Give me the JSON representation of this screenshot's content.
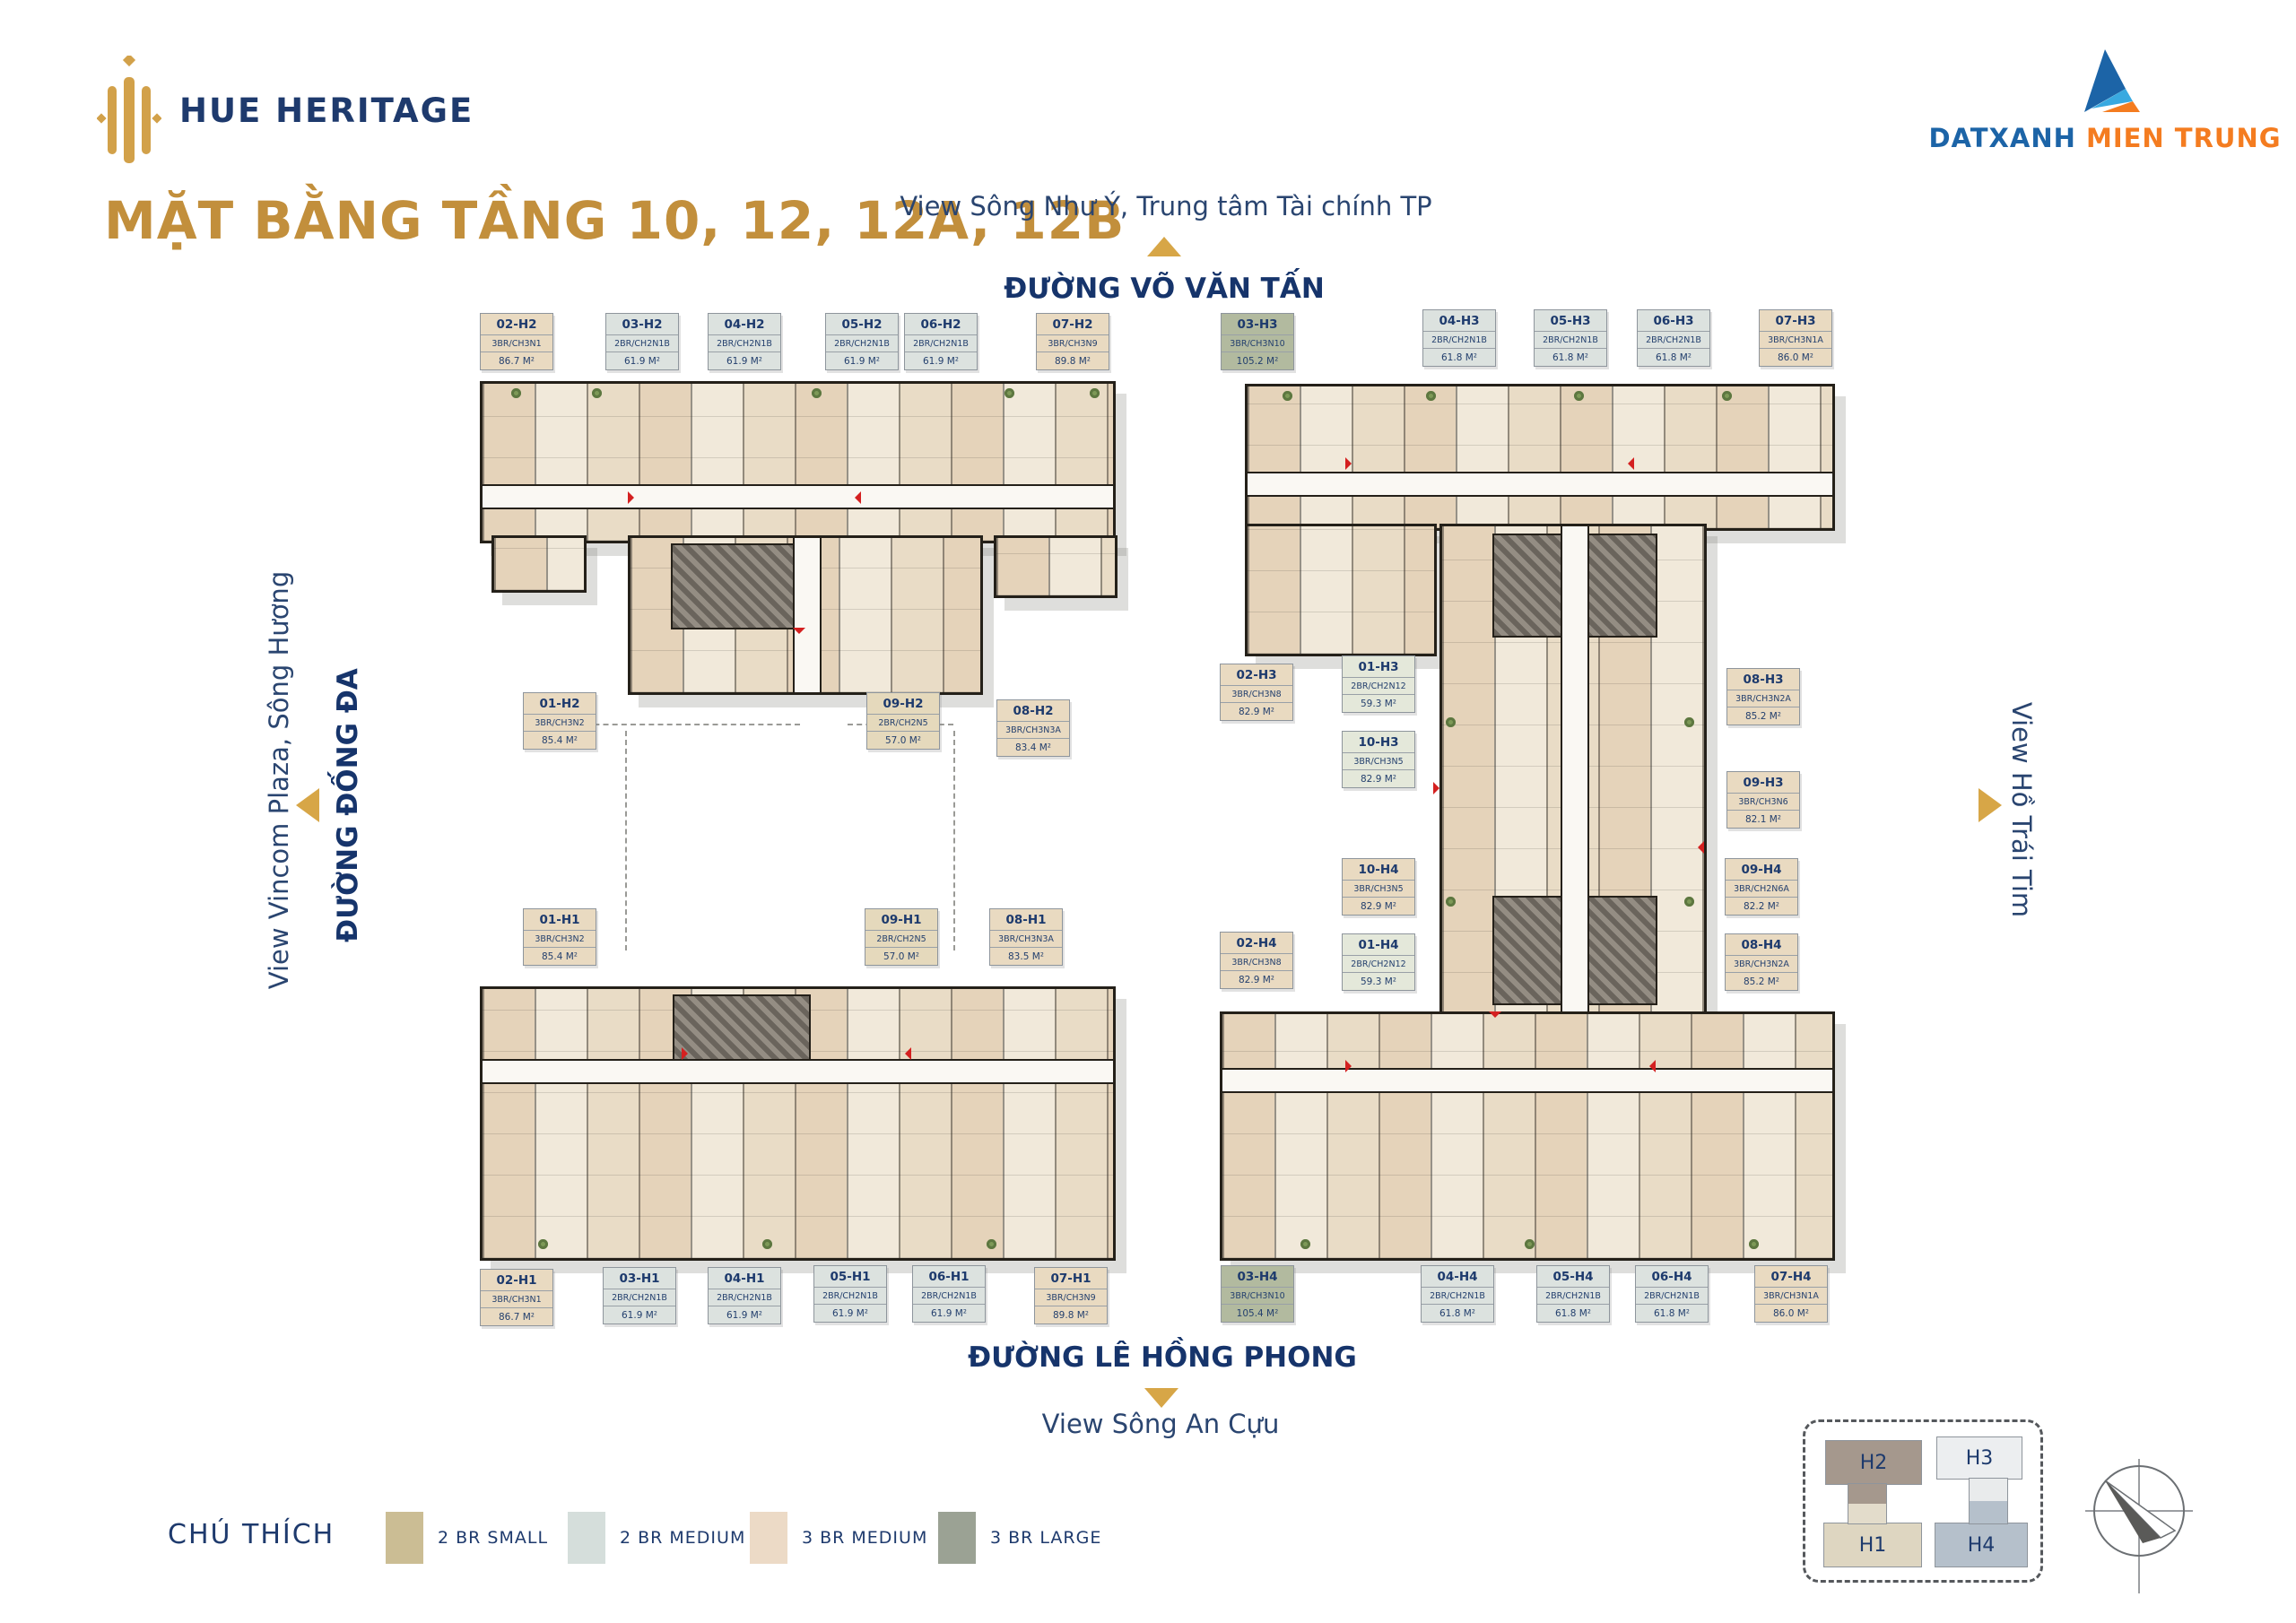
{
  "branding": {
    "logo_text": "HUE HERITAGE",
    "developer": {
      "part1": "DATXANH",
      "part2": "MIEN TRUNG"
    }
  },
  "title": "MẶT BẰNG TẦNG 10, 12, 12A, 12B",
  "directions": {
    "top": {
      "view": "View Sông Như Ý, Trung tâm Tài chính TP",
      "street": "ĐƯỜNG VÕ VĂN TẤN"
    },
    "left": {
      "view": "View Vincom Plaza, Sông Hương",
      "street": "ĐƯỜNG ĐỐNG ĐA"
    },
    "right": {
      "view": "View Hồ Trái Tim"
    },
    "bottom": {
      "street": "ĐƯỜNG LÊ HỒNG PHONG",
      "view": "View Sông An Cựu"
    }
  },
  "legend": {
    "title": "CHÚ THÍCH",
    "items": [
      {
        "label": "2 BR SMALL",
        "color": "#cbbd94"
      },
      {
        "label": "2 BR MEDIUM",
        "color": "#d5dedb"
      },
      {
        "label": "3 BR MEDIUM",
        "color": "#ecdac6"
      },
      {
        "label": "3 BR LARGE",
        "color": "#9ba294"
      }
    ]
  },
  "keyplan": {
    "blocks": [
      {
        "label": "H2",
        "color": "#a5988d"
      },
      {
        "label": "H3",
        "color": "#eceef0"
      },
      {
        "label": "H1",
        "color": "#ded6c1"
      },
      {
        "label": "H4",
        "color": "#b5c0cb"
      }
    ]
  },
  "tones": {
    "br2-small": "#e5d9bc",
    "br2-small-sage": "#e4e8da",
    "br2-medium": "#dce2df",
    "br3-medium": "#e9dac1",
    "br3-large": "#b2ba9f"
  },
  "units": [
    {
      "code": "02-H2",
      "type": "3BR/CH3N1",
      "area": "86.7 M²",
      "tone": "br3-medium"
    },
    {
      "code": "03-H2",
      "type": "2BR/CH2N1B",
      "area": "61.9 M²",
      "tone": "br2-medium"
    },
    {
      "code": "04-H2",
      "type": "2BR/CH2N1B",
      "area": "61.9 M²",
      "tone": "br2-medium"
    },
    {
      "code": "05-H2",
      "type": "2BR/CH2N1B",
      "area": "61.9 M²",
      "tone": "br2-medium"
    },
    {
      "code": "06-H2",
      "type": "2BR/CH2N1B",
      "area": "61.9 M²",
      "tone": "br2-medium"
    },
    {
      "code": "07-H2",
      "type": "3BR/CH3N9",
      "area": "89.8 M²",
      "tone": "br3-medium"
    },
    {
      "code": "01-H2",
      "type": "3BR/CH3N2",
      "area": "85.4 M²",
      "tone": "br3-medium"
    },
    {
      "code": "09-H2",
      "type": "2BR/CH2N5",
      "area": "57.0 M²",
      "tone": "br2-small"
    },
    {
      "code": "08-H2",
      "type": "3BR/CH3N3A",
      "area": "83.4 M²",
      "tone": "br3-medium"
    },
    {
      "code": "03-H3",
      "type": "3BR/CH3N10",
      "area": "105.2 M²",
      "tone": "br3-large"
    },
    {
      "code": "04-H3",
      "type": "2BR/CH2N1B",
      "area": "61.8 M²",
      "tone": "br2-medium"
    },
    {
      "code": "05-H3",
      "type": "2BR/CH2N1B",
      "area": "61.8 M²",
      "tone": "br2-medium"
    },
    {
      "code": "06-H3",
      "type": "2BR/CH2N1B",
      "area": "61.8 M²",
      "tone": "br2-medium"
    },
    {
      "code": "07-H3",
      "type": "3BR/CH3N1A",
      "area": "86.0 M²",
      "tone": "br3-medium"
    },
    {
      "code": "02-H3",
      "type": "3BR/CH3N8",
      "area": "82.9 M²",
      "tone": "br3-medium"
    },
    {
      "code": "01-H3",
      "type": "2BR/CH2N12",
      "area": "59.3 M²",
      "tone": "br2-small-sage"
    },
    {
      "code": "10-H3",
      "type": "3BR/CH3N5",
      "area": "82.9 M²",
      "tone": "br2-small-sage"
    },
    {
      "code": "08-H3",
      "type": "3BR/CH3N2A",
      "area": "85.2 M²",
      "tone": "br3-medium"
    },
    {
      "code": "09-H3",
      "type": "3BR/CH3N6",
      "area": "82.1 M²",
      "tone": "br3-medium"
    },
    {
      "code": "10-H4",
      "type": "3BR/CH3N5",
      "area": "82.9 M²",
      "tone": "br3-medium"
    },
    {
      "code": "02-H4",
      "type": "3BR/CH3N8",
      "area": "82.9 M²",
      "tone": "br3-medium"
    },
    {
      "code": "01-H4",
      "type": "2BR/CH2N12",
      "area": "59.3 M²",
      "tone": "br2-small-sage"
    },
    {
      "code": "09-H4",
      "type": "3BR/CH2N6A",
      "area": "82.2 M²",
      "tone": "br3-medium"
    },
    {
      "code": "08-H4",
      "type": "3BR/CH3N2A",
      "area": "85.2 M²",
      "tone": "br3-medium"
    },
    {
      "code": "01-H1",
      "type": "3BR/CH3N2",
      "area": "85.4 M²",
      "tone": "br3-medium"
    },
    {
      "code": "09-H1",
      "type": "2BR/CH2N5",
      "area": "57.0 M²",
      "tone": "br2-small"
    },
    {
      "code": "08-H1",
      "type": "3BR/CH3N3A",
      "area": "83.5 M²",
      "tone": "br3-medium"
    },
    {
      "code": "02-H1",
      "type": "3BR/CH3N1",
      "area": "86.7 M²",
      "tone": "br3-medium"
    },
    {
      "code": "03-H1",
      "type": "2BR/CH2N1B",
      "area": "61.9 M²",
      "tone": "br2-medium"
    },
    {
      "code": "04-H1",
      "type": "2BR/CH2N1B",
      "area": "61.9 M²",
      "tone": "br2-medium"
    },
    {
      "code": "05-H1",
      "type": "2BR/CH2N1B",
      "area": "61.9 M²",
      "tone": "br2-medium"
    },
    {
      "code": "06-H1",
      "type": "2BR/CH2N1B",
      "area": "61.9 M²",
      "tone": "br2-medium"
    },
    {
      "code": "07-H1",
      "type": "3BR/CH3N9",
      "area": "89.8 M²",
      "tone": "br3-medium"
    },
    {
      "code": "03-H4",
      "type": "3BR/CH3N10",
      "area": "105.4 M²",
      "tone": "br3-large"
    },
    {
      "code": "04-H4",
      "type": "2BR/CH2N1B",
      "area": "61.8 M²",
      "tone": "br2-medium"
    },
    {
      "code": "05-H4",
      "type": "2BR/CH2N1B",
      "area": "61.8 M²",
      "tone": "br2-medium"
    },
    {
      "code": "06-H4",
      "type": "2BR/CH2N1B",
      "area": "61.8 M²",
      "tone": "br2-medium"
    },
    {
      "code": "07-H4",
      "type": "3BR/CH3N1A",
      "area": "86.0 M²",
      "tone": "br3-medium"
    }
  ]
}
